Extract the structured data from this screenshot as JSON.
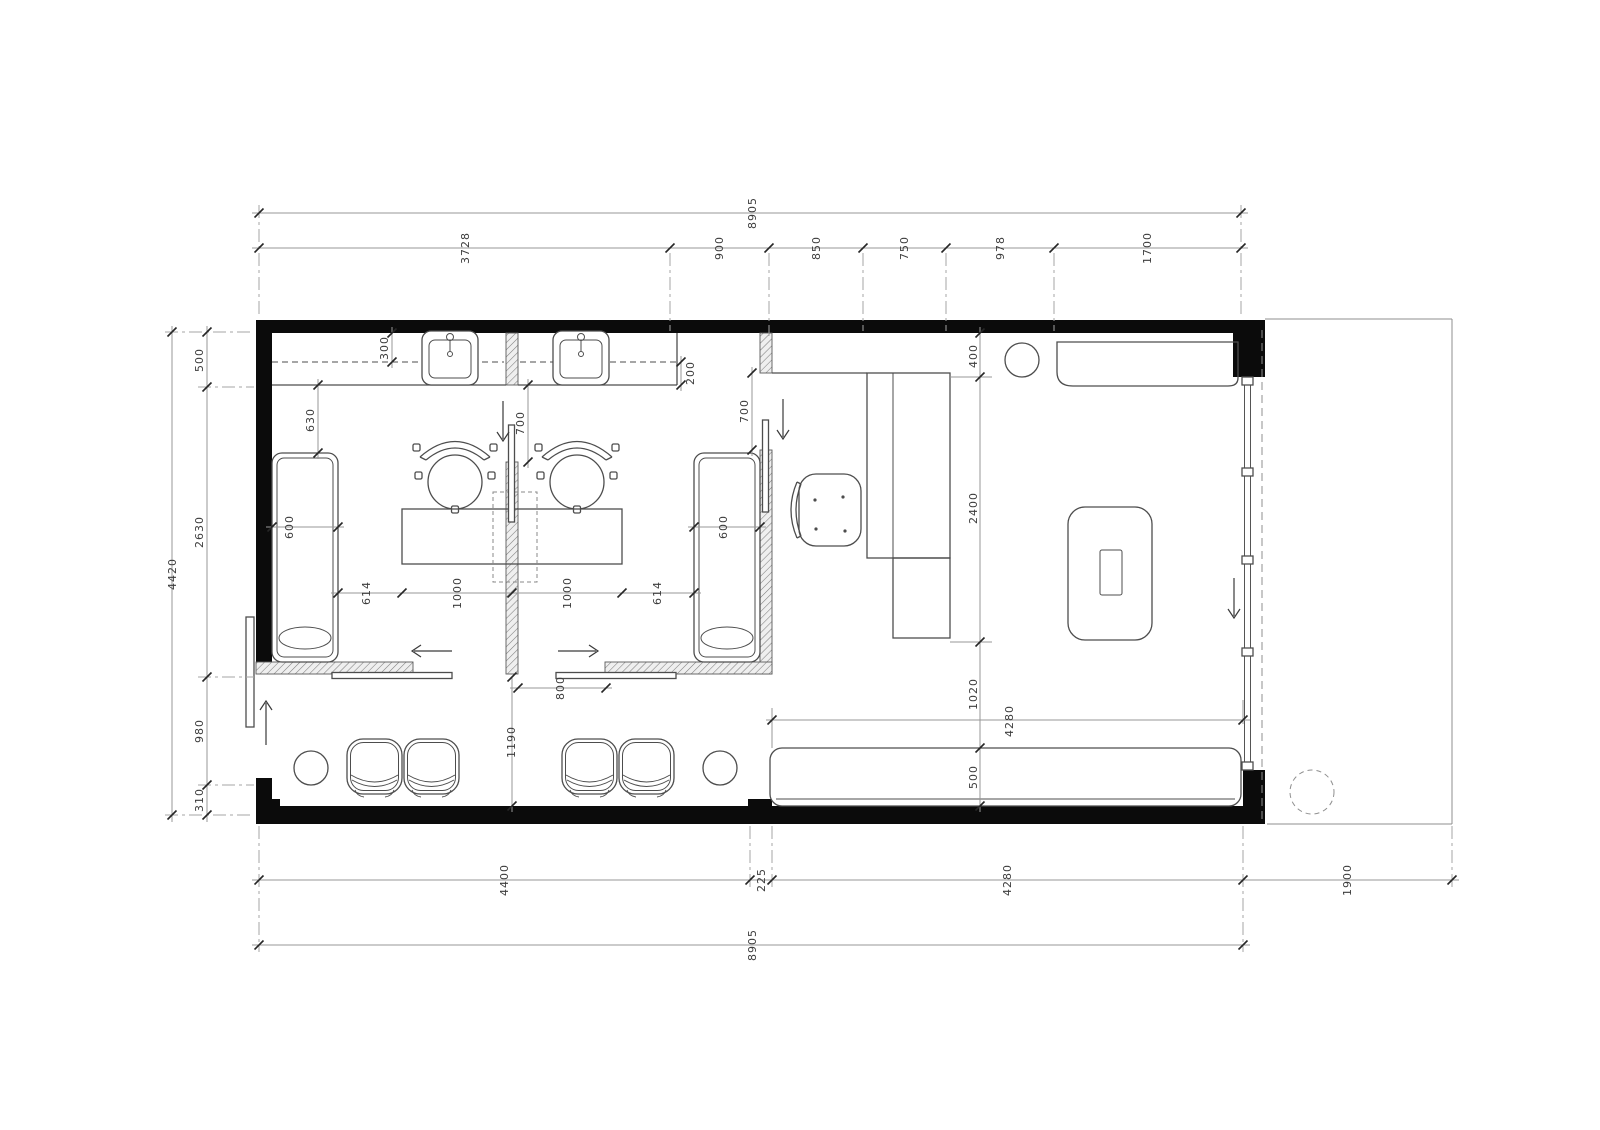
{
  "colors": {
    "wall": "#0b0b0b",
    "furniture_line": "#4d4d4d",
    "dimension_line": "#979797",
    "text": "#3c3c3c",
    "background": "#ffffff"
  },
  "dim_labels": [
    {
      "id": "top-overall",
      "text": "8905",
      "x": 756,
      "y": 213
    },
    {
      "id": "top-seg-1",
      "text": "3728",
      "x": 469,
      "y": 248
    },
    {
      "id": "top-seg-2",
      "text": "900",
      "x": 723,
      "y": 248
    },
    {
      "id": "top-seg-3",
      "text": "850",
      "x": 820,
      "y": 248
    },
    {
      "id": "top-seg-4",
      "text": "750",
      "x": 908,
      "y": 248
    },
    {
      "id": "top-seg-5",
      "text": "978",
      "x": 1004,
      "y": 248
    },
    {
      "id": "top-seg-6",
      "text": "1700",
      "x": 1151,
      "y": 248
    },
    {
      "id": "left-overall",
      "text": "4420",
      "x": 176,
      "y": 574
    },
    {
      "id": "left-seg-1",
      "text": "500",
      "x": 203,
      "y": 360
    },
    {
      "id": "left-seg-2",
      "text": "2630",
      "x": 203,
      "y": 532
    },
    {
      "id": "left-seg-3",
      "text": "980",
      "x": 203,
      "y": 731
    },
    {
      "id": "left-seg-4",
      "text": "310",
      "x": 203,
      "y": 800
    },
    {
      "id": "bottom-seg-1",
      "text": "4400",
      "x": 508,
      "y": 880
    },
    {
      "id": "bottom-seg-2",
      "text": "225",
      "x": 765,
      "y": 880
    },
    {
      "id": "bottom-seg-3",
      "text": "4280",
      "x": 1011,
      "y": 880
    },
    {
      "id": "bottom-seg-4",
      "text": "1900",
      "x": 1351,
      "y": 880
    },
    {
      "id": "bottom-overall",
      "text": "8905",
      "x": 756,
      "y": 945
    },
    {
      "id": "counter-depth",
      "text": "300",
      "x": 388,
      "y": 348
    },
    {
      "id": "counter-edge",
      "text": "200",
      "x": 694,
      "y": 373
    },
    {
      "id": "chair-zone",
      "text": "630",
      "x": 314,
      "y": 420
    },
    {
      "id": "door-left",
      "text": "700",
      "x": 524,
      "y": 423
    },
    {
      "id": "door-right",
      "text": "700",
      "x": 748,
      "y": 411
    },
    {
      "id": "couch-left-width",
      "text": "600",
      "x": 293,
      "y": 527
    },
    {
      "id": "couch-right-width",
      "text": "600",
      "x": 727,
      "y": 527
    },
    {
      "id": "mid-seg-1",
      "text": "614",
      "x": 370,
      "y": 593
    },
    {
      "id": "mid-seg-2",
      "text": "1000",
      "x": 461,
      "y": 593
    },
    {
      "id": "mid-seg-3",
      "text": "1000",
      "x": 571,
      "y": 593
    },
    {
      "id": "mid-seg-4",
      "text": "614",
      "x": 661,
      "y": 593
    },
    {
      "id": "door-bottom",
      "text": "800",
      "x": 564,
      "y": 688
    },
    {
      "id": "hall-width",
      "text": "1190",
      "x": 515,
      "y": 742
    },
    {
      "id": "right-seg-1",
      "text": "400",
      "x": 977,
      "y": 356
    },
    {
      "id": "right-seg-2",
      "text": "2400",
      "x": 977,
      "y": 508
    },
    {
      "id": "right-seg-3",
      "text": "1020",
      "x": 977,
      "y": 694
    },
    {
      "id": "bench-length",
      "text": "4280",
      "x": 1013,
      "y": 721
    },
    {
      "id": "bench-depth",
      "text": "500",
      "x": 977,
      "y": 777
    }
  ]
}
